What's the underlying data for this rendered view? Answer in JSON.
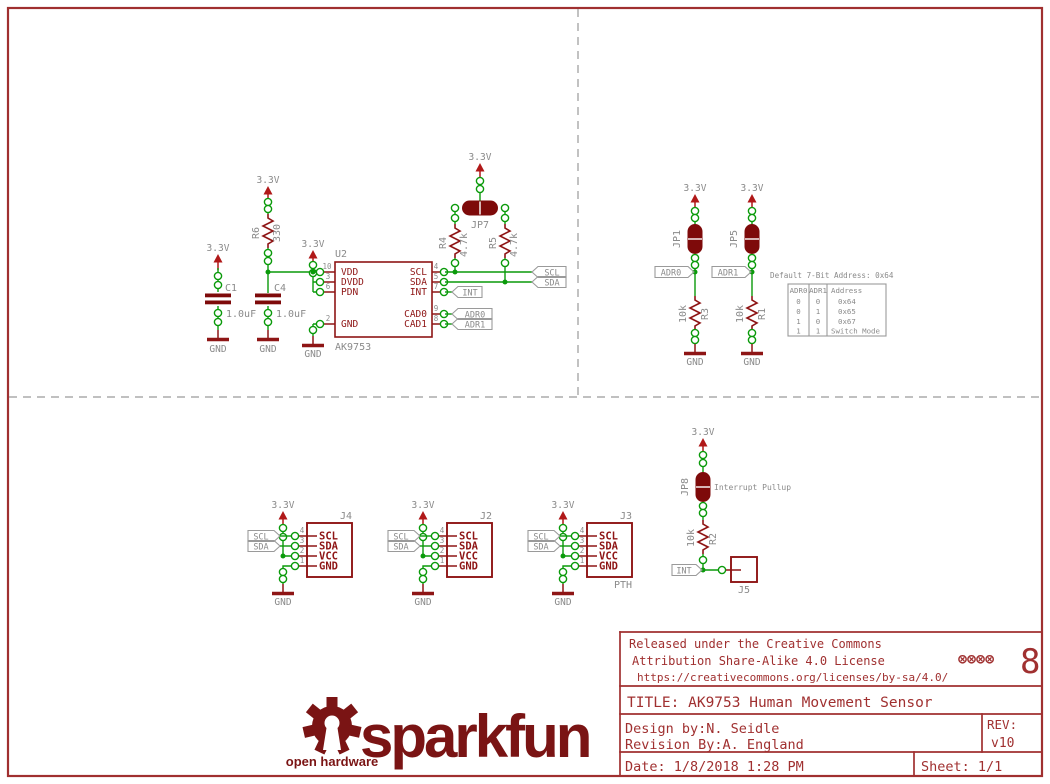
{
  "labels": {
    "v33": "3.3V",
    "gnd": "GND"
  },
  "ic": {
    "ref": "U2",
    "value": "AK9753",
    "left_pins": [
      {
        "num": "10",
        "name": "VDD"
      },
      {
        "num": "3",
        "name": "DVDD"
      },
      {
        "num": "6",
        "name": "PDN"
      },
      {
        "num": "2",
        "name": "GND"
      }
    ],
    "right_pins": [
      {
        "num": "4",
        "name": "SCL"
      },
      {
        "num": "5",
        "name": "SDA"
      },
      {
        "num": "7",
        "name": "INT"
      },
      {
        "num": "9",
        "name": "CAD0"
      },
      {
        "num": "8",
        "name": "CAD1"
      }
    ]
  },
  "parts": {
    "c1": {
      "ref": "C1",
      "value": "1.0uF"
    },
    "c4": {
      "ref": "C4",
      "value": "1.0uF"
    },
    "r6": {
      "ref": "R6",
      "value": "330"
    },
    "r4": {
      "ref": "R4",
      "value": "4.7k"
    },
    "r5": {
      "ref": "R5",
      "value": "4.7k"
    },
    "r3": {
      "ref": "R3",
      "value": "10k"
    },
    "r1": {
      "ref": "R1",
      "value": "10k"
    },
    "r2": {
      "ref": "R2",
      "value": "10k"
    },
    "jp1": {
      "ref": "JP1"
    },
    "jp5": {
      "ref": "JP5"
    },
    "jp7": {
      "ref": "JP7"
    },
    "jp8": {
      "ref": "JP8",
      "note": "Interrupt Pullup"
    },
    "j5": {
      "ref": "J5"
    }
  },
  "nets": {
    "scl": "SCL",
    "sda": "SDA",
    "int": "INT",
    "adr0": "ADR0",
    "adr1": "ADR1"
  },
  "address_info": {
    "note": "Default 7-Bit Address: 0x64",
    "table": {
      "headers": [
        "ADR0",
        "ADR1",
        "Address"
      ],
      "rows": [
        [
          "0",
          "0",
          "0x64"
        ],
        [
          "0",
          "1",
          "0x65"
        ],
        [
          "1",
          "0",
          "0x67"
        ],
        [
          "1",
          "1",
          "Switch Mode"
        ]
      ]
    }
  },
  "connectors": [
    {
      "ref": "J4",
      "note": "",
      "pins": [
        {
          "num": "4",
          "name": "SCL"
        },
        {
          "num": "3",
          "name": "SDA"
        },
        {
          "num": "2",
          "name": "VCC"
        },
        {
          "num": "1",
          "name": "GND"
        }
      ]
    },
    {
      "ref": "J2",
      "note": "",
      "pins": [
        {
          "num": "4",
          "name": "SCL"
        },
        {
          "num": "3",
          "name": "SDA"
        },
        {
          "num": "2",
          "name": "VCC"
        },
        {
          "num": "1",
          "name": "GND"
        }
      ]
    },
    {
      "ref": "J3",
      "note": "PTH",
      "pins": [
        {
          "num": "4",
          "name": "SCL"
        },
        {
          "num": "3",
          "name": "SDA"
        },
        {
          "num": "2",
          "name": "VCC"
        },
        {
          "num": "1",
          "name": "GND"
        }
      ]
    }
  ],
  "title_block": {
    "license_line1": "Released under the Creative Commons",
    "license_line2": "Attribution Share-Alike 4.0 License",
    "license_url": "https://creativecommons.org/licenses/by-sa/4.0/",
    "cc_marks": "⊗⊗⊗⊗",
    "mark8": "8",
    "title": "TITLE: AK9753 Human Movement Sensor",
    "design_by": "Design by:N. Seidle",
    "revision_by": "Revision By:A. England",
    "rev_label": "REV:",
    "rev_value": "v10",
    "date": "Date: 1/8/2018 1:28 PM",
    "sheet": "Sheet: 1/1"
  },
  "logo": {
    "brand": "sparkfun",
    "oshw": "open hardware"
  }
}
